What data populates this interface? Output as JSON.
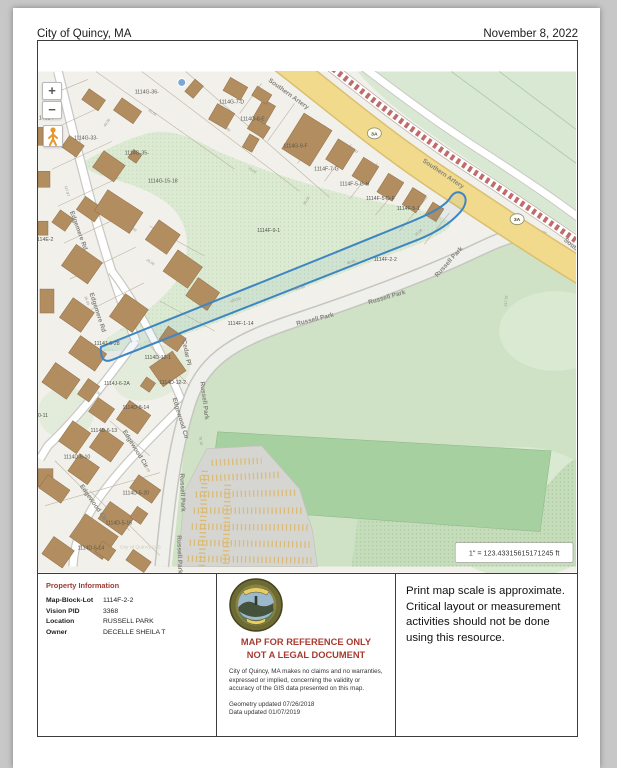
{
  "header": {
    "title": "City of Quincy, MA",
    "date": "November 8, 2022"
  },
  "map": {
    "scale_label": "1\" = 123.43315615171245 ft",
    "watermark": "City of Quincy GIS",
    "highlight_parcel": "1114F-2-2",
    "controls": {
      "zoom_in": "+",
      "zoom_out": "−",
      "pegman": "street-view"
    },
    "colors": {
      "land": "#f2f0eb",
      "park": "#cfe2c6",
      "park_light": "#d9e8d2",
      "field": "#a7d0a0",
      "road_major": "#f2da8c",
      "rail": "#c06c6c",
      "building": "#b28d60",
      "highlight": "#3e86c2",
      "lot": "#d5d5d1"
    },
    "route_shields": [
      {
        "label": "3A",
        "x": 375,
        "y": 132
      },
      {
        "label": "3A",
        "x": 518,
        "y": 218
      }
    ],
    "text_layers": {
      "street": {
        "size": 6.4,
        "fill": "#83837b",
        "weight": "bold",
        "items": [
          {
            "t": "Southern Artery",
            "x": 288,
            "y": 94,
            "r": 36
          },
          {
            "t": "Southern Artery",
            "x": 443,
            "y": 174,
            "r": 34
          },
          {
            "t": "Southern Artery",
            "x": 583,
            "y": 255,
            "r": 40
          },
          {
            "t": "Edgemere Rd",
            "x": 77,
            "y": 230,
            "r": 70
          },
          {
            "t": "Edgemere Rd",
            "x": 96,
            "y": 312,
            "r": 72
          },
          {
            "t": "Cedar Pl",
            "x": 185,
            "y": 352,
            "r": 78
          },
          {
            "t": "Edgewood Cir",
            "x": 179,
            "y": 418,
            "r": 73
          },
          {
            "t": "Edgewood Cir",
            "x": 134,
            "y": 449,
            "r": 58
          },
          {
            "t": "Edgewood Cir",
            "x": 92,
            "y": 503,
            "r": 55
          },
          {
            "t": "Russell Park",
            "x": 203,
            "y": 400,
            "r": 83
          },
          {
            "t": "Russell Park",
            "x": 181,
            "y": 492,
            "r": 88
          },
          {
            "t": "Russell Park",
            "x": 178,
            "y": 554,
            "r": 88
          },
          {
            "t": "Russell Park",
            "x": 316,
            "y": 320,
            "r": -14
          },
          {
            "t": "Russell Park",
            "x": 388,
            "y": 298,
            "r": -16
          },
          {
            "t": "Russell Park",
            "x": 451,
            "y": 262,
            "r": -48
          }
        ]
      },
      "parcel": {
        "size": 5.2,
        "fill": "#55554d",
        "weight": "normal",
        "items": [
          {
            "t": "1114G-36-",
            "x": 147,
            "y": 92,
            "r": 0
          },
          {
            "t": "1114G-7-D",
            "x": 232,
            "y": 102,
            "r": 0
          },
          {
            "t": "1114G-8-E",
            "x": 253,
            "y": 119,
            "r": 0
          },
          {
            "t": "1114G-9-F",
            "x": 296,
            "y": 146,
            "r": 0
          },
          {
            "t": "1114G-33-",
            "x": 86,
            "y": 138,
            "r": 0
          },
          {
            "t": "1114G-35-",
            "x": 137,
            "y": 153,
            "r": 0
          },
          {
            "t": "1114G-15-18",
            "x": 163,
            "y": 181,
            "r": 0
          },
          {
            "t": "14024-",
            "x": 47,
            "y": 118,
            "r": 0
          },
          {
            "t": "1114E-2",
            "x": 44,
            "y": 240,
            "r": 0
          },
          {
            "t": "1114F-9-1",
            "x": 269,
            "y": 231,
            "r": 0
          },
          {
            "t": "1114F-2-2",
            "x": 386,
            "y": 260,
            "r": 0
          },
          {
            "t": "1114F-7-G",
            "x": 327,
            "y": 169,
            "r": 0
          },
          {
            "t": "1114F-5-G-H",
            "x": 355,
            "y": 184,
            "r": 0
          },
          {
            "t": "1114F-5-D-F",
            "x": 381,
            "y": 199,
            "r": 0
          },
          {
            "t": "1114F-5-1",
            "x": 409,
            "y": 209,
            "r": 0
          },
          {
            "t": "1114F-1-14",
            "x": 241,
            "y": 324,
            "r": 0
          },
          {
            "t": "1114J-6-28",
            "x": 107,
            "y": 344,
            "r": 0
          },
          {
            "t": "1114D-12-1",
            "x": 158,
            "y": 358,
            "r": 0
          },
          {
            "t": "1114D-12-2",
            "x": 173,
            "y": 383,
            "r": 0
          },
          {
            "t": "1114J-6-2A",
            "x": 117,
            "y": 384,
            "r": 0
          },
          {
            "t": "1114D-8-14",
            "x": 136,
            "y": 408,
            "r": 0
          },
          {
            "t": "1114D-6-13",
            "x": 104,
            "y": 431,
            "r": 0
          },
          {
            "t": "0-11",
            "x": 43,
            "y": 416,
            "r": 0
          },
          {
            "t": "1114D-5-10",
            "x": 77,
            "y": 458,
            "r": 0
          },
          {
            "t": "1114D-5-20",
            "x": 136,
            "y": 494,
            "r": 0
          },
          {
            "t": "1114D-5-16",
            "x": 119,
            "y": 524,
            "r": 0
          },
          {
            "t": "1114D-5-14",
            "x": 91,
            "y": 549,
            "r": 0
          }
        ]
      },
      "dims": {
        "size": 3.6,
        "fill": "#97938a",
        "weight": "normal",
        "items": [
          {
            "t": "40.00",
            "x": 108,
            "y": 122,
            "r": -55
          },
          {
            "t": "50.06",
            "x": 152,
            "y": 112,
            "r": 35
          },
          {
            "t": "117.87",
            "x": 66,
            "y": 190,
            "r": 75
          },
          {
            "t": "49.50",
            "x": 226,
            "y": 128,
            "r": 30
          },
          {
            "t": "75.00",
            "x": 252,
            "y": 170,
            "r": 32
          },
          {
            "t": "90.00",
            "x": 308,
            "y": 200,
            "r": -58
          },
          {
            "t": "44.97",
            "x": 354,
            "y": 150,
            "r": 32
          },
          {
            "t": "32.00",
            "x": 420,
            "y": 232,
            "r": -40
          },
          {
            "t": "25.00",
            "x": 150,
            "y": 262,
            "r": 35
          },
          {
            "t": "100.00",
            "x": 236,
            "y": 300,
            "r": -15
          },
          {
            "t": "193.95",
            "x": 300,
            "y": 288,
            "r": -14
          },
          {
            "t": "45.08",
            "x": 352,
            "y": 262,
            "r": -15
          },
          {
            "t": "217.52",
            "x": 508,
            "y": 300,
            "r": -85
          },
          {
            "t": "60.00",
            "x": 96,
            "y": 392,
            "r": 35
          },
          {
            "t": "55.00",
            "x": 146,
            "y": 468,
            "r": 55
          },
          {
            "t": "70.10",
            "x": 200,
            "y": 440,
            "r": 80
          },
          {
            "t": "35.00",
            "x": 86,
            "y": 300,
            "r": 70
          },
          {
            "t": "48.00",
            "x": 132,
            "y": 228,
            "r": 35
          }
        ]
      }
    }
  },
  "property_info": {
    "heading": "Property Information",
    "rows": [
      {
        "label": "Map-Block-Lot",
        "value": "1114F-2-2"
      },
      {
        "label": "Vision PID",
        "value": "3368"
      },
      {
        "label": "Location",
        "value": "RUSSELL PARK"
      },
      {
        "label": "Owner",
        "value": "DECELLE SHEILA T"
      }
    ]
  },
  "disclaimer": {
    "line1": "MAP FOR REFERENCE ONLY",
    "line2": "NOT A LEGAL DOCUMENT",
    "body": "City of Quincy, MA makes no claims and no warranties, expressed or implied, concerning the validity or accuracy of the GIS data presented on this map.",
    "geometry_updated": "Geometry updated 07/26/2018",
    "data_updated": "Data updated 01/07/2019"
  },
  "print_note": "Print map scale is approximate. Critical layout or measurement activities should not be done using this resource."
}
